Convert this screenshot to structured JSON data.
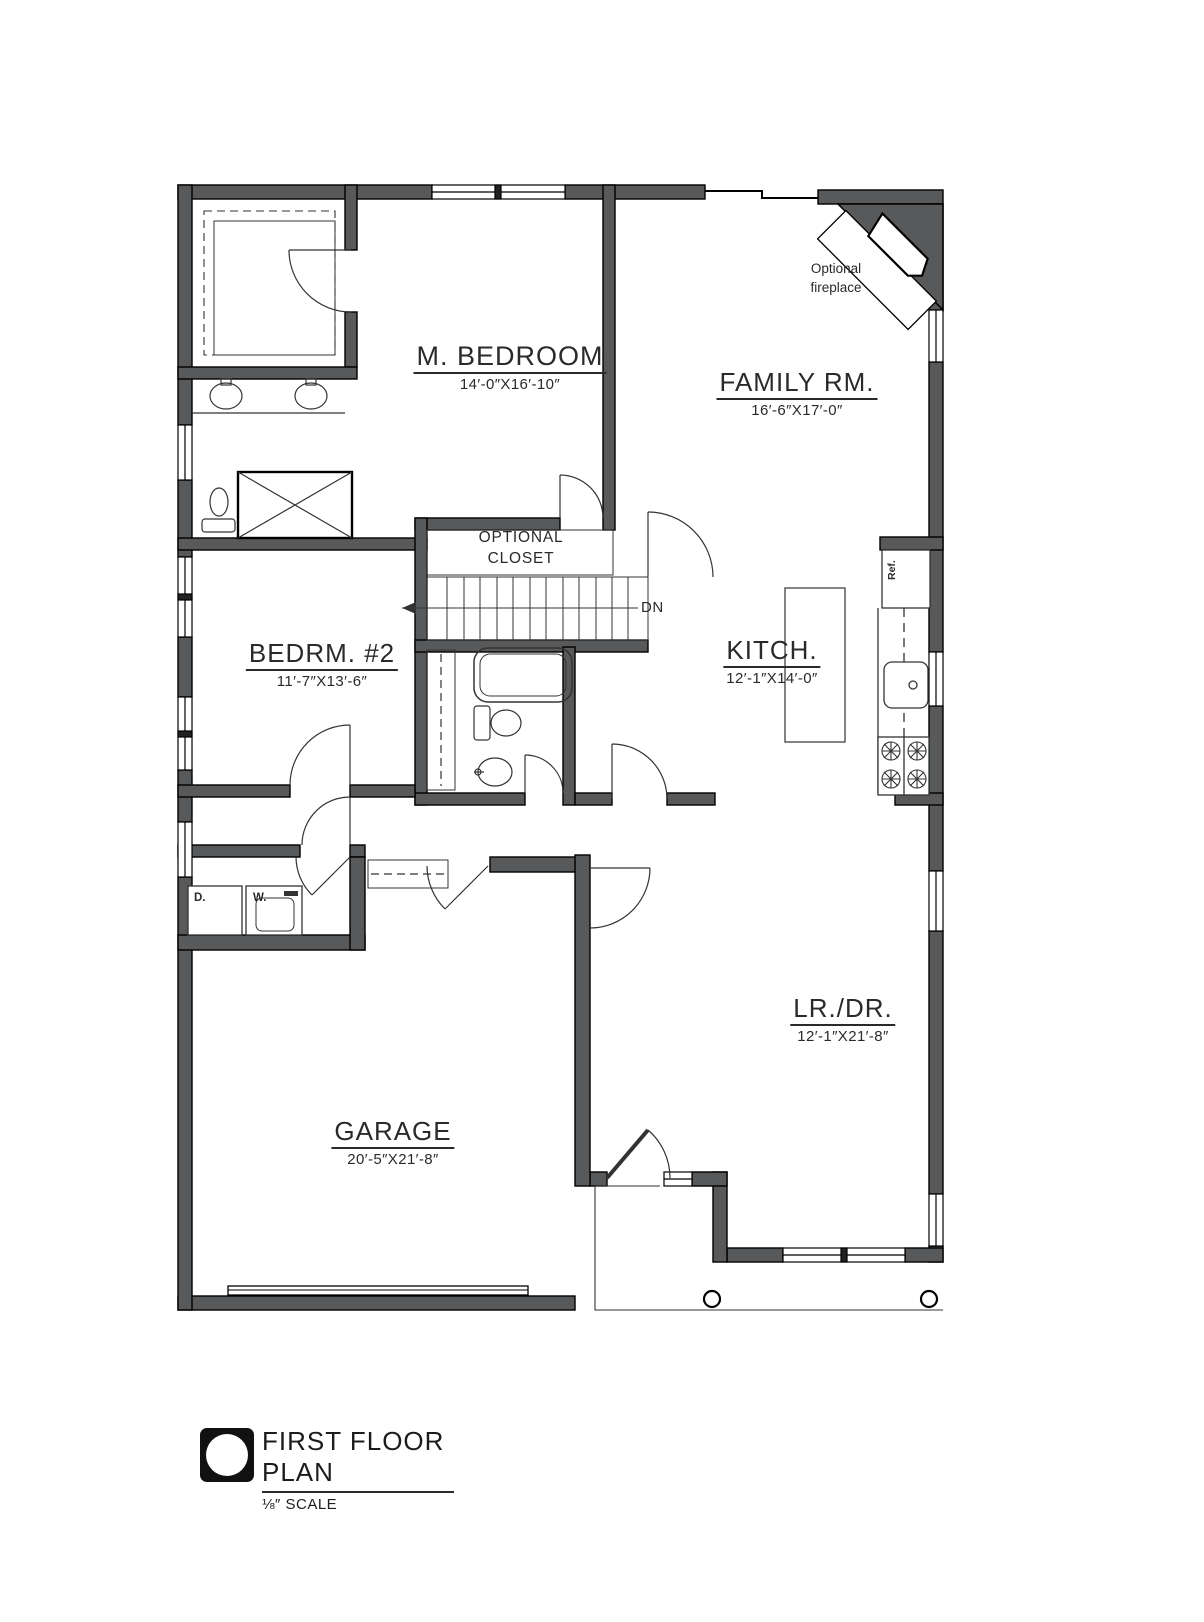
{
  "drawing": {
    "type": "architectural_floor_plan",
    "rooms": [
      {
        "id": "m_bedroom",
        "name": "M. BEDROOM",
        "dims": "14′-0″X16′-10″"
      },
      {
        "id": "family_room",
        "name": "FAMILY RM.",
        "dims": "16′-6″X17′-0″"
      },
      {
        "id": "bedroom_2",
        "name": "BEDRM. #2",
        "dims": "11′-7″X13′-6″"
      },
      {
        "id": "kitchen",
        "name": "KITCH.",
        "dims": "12′-1″X14′-0″"
      },
      {
        "id": "living_dining",
        "name": "LR./DR.",
        "dims": "12′-1″X21′-8″"
      },
      {
        "id": "garage",
        "name": "GARAGE",
        "dims": "20′-5″X21′-8″"
      }
    ],
    "annotations": {
      "optional_fireplace_line1": "Optional",
      "optional_fireplace_line2": "fireplace",
      "optional_closet_line1": "OPTIONAL",
      "optional_closet_line2": "CLOSET",
      "stairs_direction": "DN",
      "dryer": "D.",
      "washer": "W.",
      "refrigerator": "Ref."
    },
    "title_block": {
      "title": "FIRST FLOOR PLAN",
      "scale": "⅛″ SCALE"
    },
    "colors": {
      "wall_fill": "#58595b",
      "line": "#231f20",
      "background": "#ffffff"
    }
  }
}
